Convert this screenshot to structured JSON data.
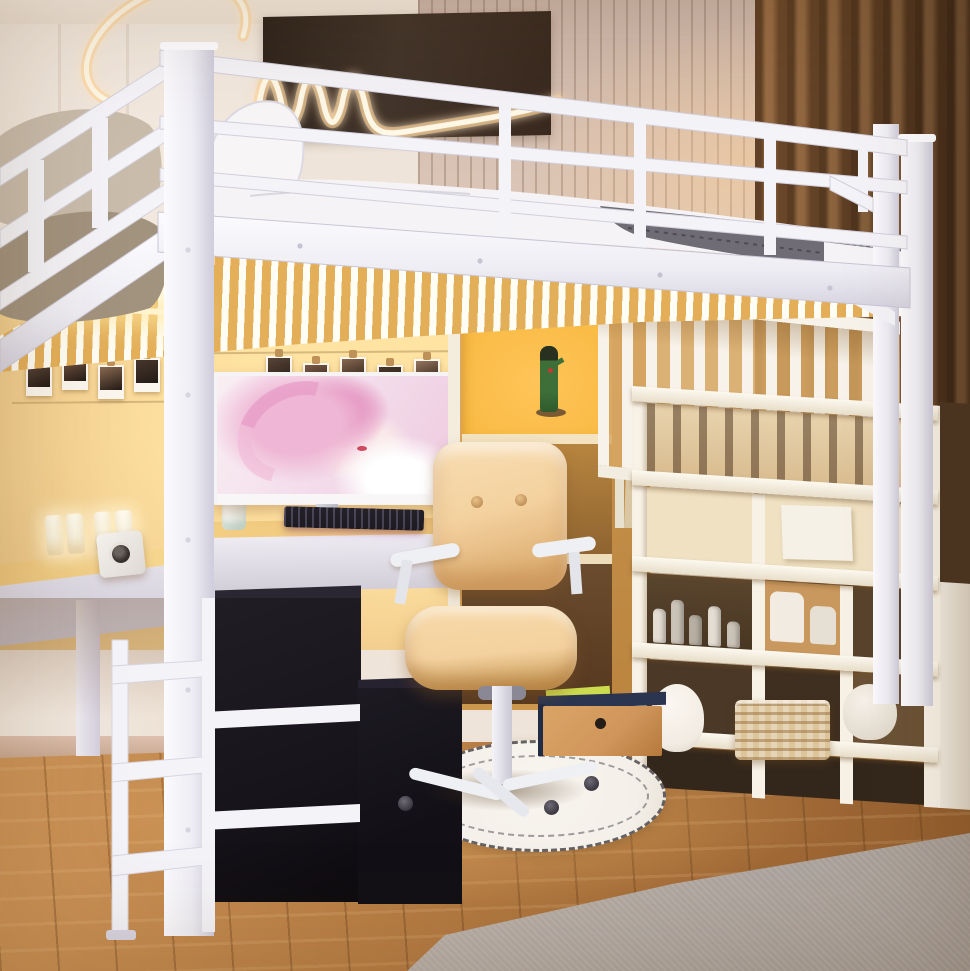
{
  "scene": {
    "type": "photograph",
    "description": "Bright bedroom with a white metal loft bed above a study nook: L-shaped desk with ultrawide monitor showing pink digital artwork, black RGB keyboard, white LED clock, polaroid photo wall, beige ergonomic chair on a round white rug, wooden bookcase with anime figurine and cat-ear headphones, white staircase storage shelves with cosmetics and baskets, black storage cubes, warm LED strip lighting, neon wall light, brown curtains, wood floor and gray carpet."
  },
  "objects": {
    "ceiling": "Ceiling with warm cove light",
    "left_wall": "Cream paneled wall",
    "slat_panel": "Beige vertical slat wall panel",
    "accent_panel": "Dark brown accent wall panel",
    "neon_light": "Warm white neon squiggle wall light",
    "curtain": "Floor-length brown curtains",
    "loft_bed": "White metal loft bed frame with guardrails and ladder",
    "bedding": "White duvet and gray patterned blanket",
    "pillows": "Beige and white pillows",
    "led_strip": "Warm LED strip under bed deck",
    "photo_wall": "Wire photo wall with polaroid snapshots",
    "desk_left": "White desk return with wood top",
    "desk_back": "Wood study desk under the loft",
    "led_clock": "White 3D LED digit clock",
    "cube_camera": "White cube gadget with round lens",
    "mug": "White mug",
    "monitor": "Ultrawide monitor with pink portrait artwork",
    "keyboard": "Black RGB gaming keyboard",
    "bookcase": "Wooden bookcase hutch with lit display cubby",
    "figurine": "Green anime figurine in lit cubby",
    "headphones": "Pink cat-ear headphones on stand",
    "books": "Books on hutch shelf",
    "balustrade": "White vertical-slat stair balustrade",
    "staircase": "White staircase storage shelves",
    "cubby_bottles": "Cosmetic bottles in stair cubby",
    "jars": "White storage jars",
    "basket": "Woven storage basket",
    "plush": "White plush toys",
    "drawer_box": "Navy storage box with wood drawer",
    "storage_cubes": "Black fabric storage cubes",
    "office_chair": "Beige tufted ergonomic desk chair",
    "rug": "Round white rug with black dashed border",
    "floor": "Warm wood plank floor",
    "carpet": "Gray area carpet"
  },
  "photo_wall": {
    "count": 11,
    "label": "Polaroid photos clipped to wires",
    "photo_colors": [
      "#5a463a",
      "#7a5a49",
      "#8a6a52",
      "#46372d",
      "#97775f"
    ]
  },
  "clock": {
    "digit_count": 4,
    "label": "White LED digit blocks"
  },
  "stairs": {
    "step_count": 5
  },
  "bottles": {
    "count": 5,
    "heights": [
      34,
      44,
      30,
      40,
      26
    ],
    "lefts": [
      6,
      24,
      42,
      61,
      80
    ]
  },
  "colors": {
    "ceiling": "#f5ebe0",
    "ceilingGlow": "#ffdfae",
    "wallCream": "#efe4d9",
    "wallSeam": "#d9c8b8",
    "slatBase": "#d5bfb1",
    "slatLine": "#8a6a56",
    "panelDark": "#43352b",
    "panelDark2": "#2f241c",
    "neonCore": "#fff8e6",
    "neonGlow": "#ffd28e",
    "curtainLight": "#8a5c36",
    "curtainMid": "#6e4929",
    "curtainDark": "#50331d",
    "frame": "#f4f3f7",
    "frameShade": "#d8d5e1",
    "frameDark": "#b9b6c6",
    "mattress": "#f5f3f5",
    "duvetShade": "#d9d6dd",
    "blanket": "#6f6c75",
    "blanketDark": "#4e4b55",
    "stitch": "#cfccd6",
    "pillow": "#c9bcab",
    "pillowDark": "#a2937e",
    "warmGlow": "#ffe3a3",
    "warmMid": "#f4d192",
    "warmEdge": "#e5c083",
    "led": "#fff4cd",
    "photoPaper": "#fbf7ee",
    "wire": "#d8c49a",
    "clip": "#bd9157",
    "bezel": "#f6f3f5",
    "artBase": "#f9eff3",
    "artPink": "#efb7d5",
    "artDeep": "#e18cbc",
    "artLips": "#cf4a60",
    "deskWood": "#eec277",
    "deskWoodLit": "#f8db95",
    "fascia": "#e9e6ee",
    "fasciaShade": "#ccc8d5",
    "keyboard": "#1d1a21",
    "keyGlow": "#9a8fb4",
    "gadget": "#f3efe9",
    "lens": "#37322e",
    "bookWood": "#dfa95f",
    "bookWoodDark": "#bb853f",
    "bookGlow": "#ffc459",
    "figure": "#3e6f38",
    "figureDark": "#28301f",
    "accentRed": "#c23b30",
    "headphone": "#e7a3b6",
    "stairWhite": "#f8f2e6",
    "stairShade": "#e7dcc7",
    "cubbyWood": "#c9985e",
    "cubbyDark": "#4b3827",
    "cubbyCream": "#efe1c2",
    "bottleLight": "#e4ddd2",
    "bottleDark": "#b7afa2",
    "basket": "#dcc49b",
    "basketLine": "#a8854f",
    "plush": "#f1ebe2",
    "cubeBlack": "#17141b",
    "cubeBlackTop": "#2b2732",
    "drawerNavy": "#2b3550",
    "drawerWood": "#d0955a",
    "folder": "#cddc4e",
    "chair": "#f4d2a0",
    "chairShade": "#ddae72",
    "chairDeep": "#c3934e",
    "chairFrame": "#eef0f4",
    "rug": "#f4f0e9",
    "rugDash": "#353238",
    "floor": "#b67c44",
    "floorDark": "#925d2d",
    "floorLit": "#cf9659",
    "carpet": "#b5aca5",
    "carpetLit": "#c8c0b9"
  }
}
